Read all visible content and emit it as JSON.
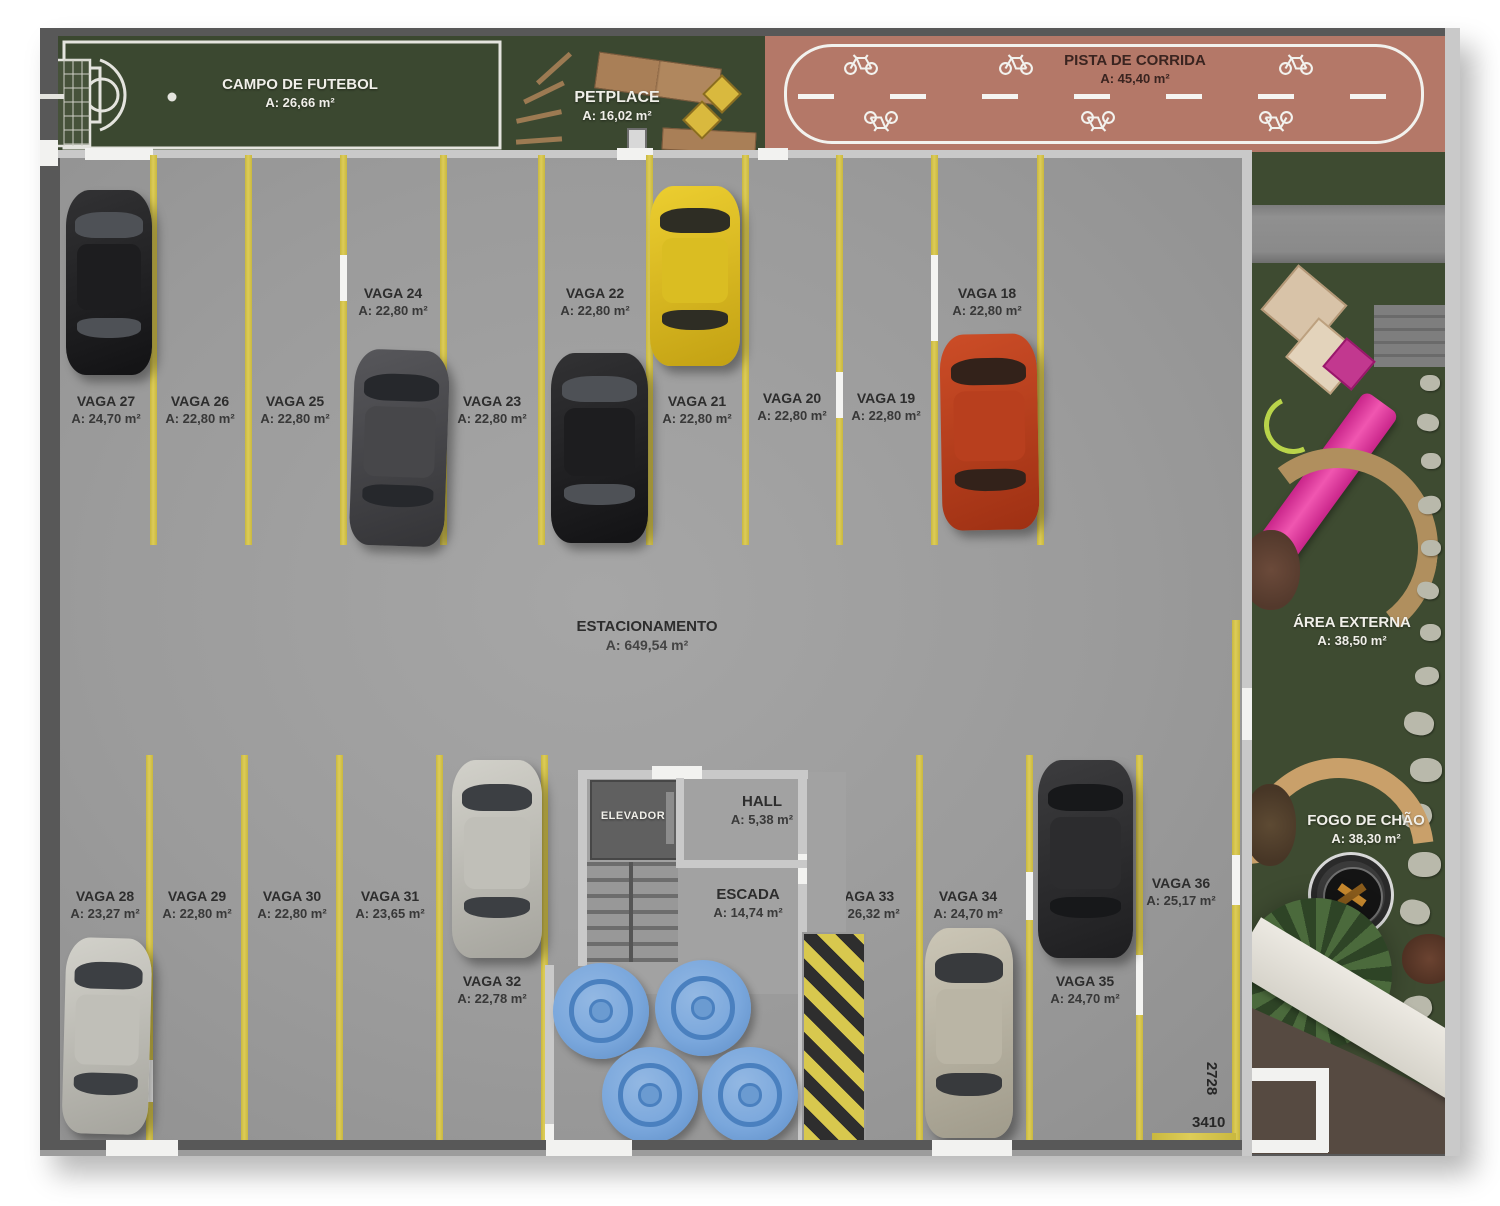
{
  "amenities": {
    "field": {
      "name": "CAMPO DE FUTEBOL",
      "area": "A: 26,66 m²"
    },
    "petplace": {
      "name": "PETPLACE",
      "area": "A: 16,02 m²"
    },
    "track": {
      "name": "PISTA DE CORRIDA",
      "area": "A: 45,40 m²"
    },
    "external": {
      "name": "ÁREA EXTERNA",
      "area": "A: 38,50 m²"
    },
    "firepit": {
      "name": "FOGO DE CHÃO",
      "area": "A: 38,30 m²"
    }
  },
  "parking": {
    "name": "ESTACIONAMENTO",
    "area": "A: 649,54 m²"
  },
  "core": {
    "elevator": "ELEVADOR",
    "hall": {
      "name": "HALL",
      "area": "A: 5,38 m²"
    },
    "stairs": {
      "name": "ESCADA",
      "area": "A: 14,74 m²"
    }
  },
  "stalls": [
    {
      "name": "VAGA 27",
      "area": "A: 24,70 m²"
    },
    {
      "name": "VAGA 26",
      "area": "A: 22,80 m²"
    },
    {
      "name": "VAGA 25",
      "area": "A: 22,80 m²"
    },
    {
      "name": "VAGA 24",
      "area": "A: 22,80 m²"
    },
    {
      "name": "VAGA 23",
      "area": "A: 22,80 m²"
    },
    {
      "name": "VAGA 22",
      "area": "A: 22,80 m²"
    },
    {
      "name": "VAGA 21",
      "area": "A: 22,80 m²"
    },
    {
      "name": "VAGA 20",
      "area": "A: 22,80 m²"
    },
    {
      "name": "VAGA 19",
      "area": "A: 22,80 m²"
    },
    {
      "name": "VAGA 18",
      "area": "A: 22,80 m²"
    },
    {
      "name": "VAGA 28",
      "area": "A: 23,27 m²"
    },
    {
      "name": "VAGA 29",
      "area": "A: 22,80 m²"
    },
    {
      "name": "VAGA 30",
      "area": "A: 22,80 m²"
    },
    {
      "name": "VAGA 31",
      "area": "A: 23,65 m²"
    },
    {
      "name": "VAGA 32",
      "area": "A: 22,78 m²"
    },
    {
      "name": "VAGA 33",
      "area": "A: 26,32 m²"
    },
    {
      "name": "VAGA 34",
      "area": "A: 24,70 m²"
    },
    {
      "name": "VAGA 35",
      "area": "A: 24,70 m²"
    },
    {
      "name": "VAGA 36",
      "area": "A: 25,17 m²"
    }
  ],
  "dimensions": {
    "vertical": "2728",
    "horizontal": "3410"
  },
  "icons": [
    "bicycle-icon",
    "soccer-goal-icon",
    "fire-pit-icon",
    "palm-tree-icon"
  ],
  "colors": {
    "accent_yellow": "#d8c84e",
    "asphalt": "#9b9b9b",
    "grass": "#3b4830",
    "track_salmon": "#b47868",
    "pouf_blue": "#7aa7dc",
    "slide_pink": "#d12a8e",
    "wall_dark": "#585858",
    "wall_light": "#c9c9c9"
  }
}
